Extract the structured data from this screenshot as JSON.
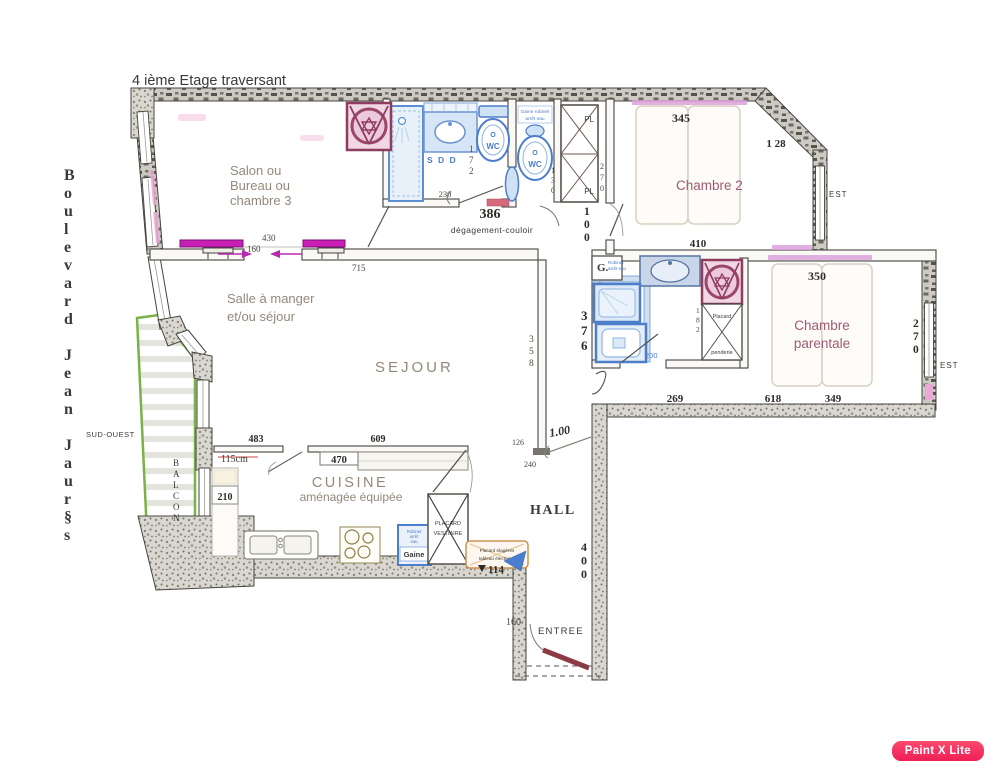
{
  "page": {
    "title": "4 ième Etage traversant",
    "watermark": "Paint X Lite"
  },
  "street": "Boulevard Jean Jaur§s",
  "orientation": {
    "sud_ouest": "SUD-OUEST",
    "est_chambre2": "EST",
    "est_parentale": "EST"
  },
  "rooms": {
    "salon": {
      "lines": [
        "Salon ou",
        "Bureau ou",
        "chambre 3"
      ]
    },
    "chambre2": "Chambre 2",
    "salle_a_manger": {
      "lines": [
        "Salle à manger",
        "et/ou séjour"
      ]
    },
    "sejour": "SEJOUR",
    "chambre_parentale": {
      "lines": [
        "Chambre",
        "parentale"
      ]
    },
    "cuisine": {
      "lines": [
        "CUISINE",
        "aménagée équipée"
      ]
    },
    "hall": "HALL",
    "entree": "ENTREE",
    "balcon": "BALCON",
    "couloir": "dégagement-couloir"
  },
  "fixtures": {
    "sdd": "S D D",
    "wc1": {
      "top": "O",
      "label": "WC"
    },
    "wc2": {
      "top": "O",
      "label": "WC"
    },
    "wc2_note": {
      "lines": [
        "Gaine robinet",
        "arrêt eau"
      ]
    },
    "pl_top": "PL",
    "pl_bottom": "PL",
    "g_box": {
      "label": "G.",
      "note": [
        "Robinet",
        "arrêt eau"
      ]
    },
    "gaine": {
      "label": "Gaine",
      "note": [
        "Robinet",
        "arrêt",
        "eau"
      ]
    },
    "placard_vestiaire": {
      "lines": [
        "PLACARD",
        "VESTIAIRE"
      ]
    },
    "placard_penderie": {
      "lines": [
        "Placard",
        "penderie"
      ]
    },
    "placard_etageres": {
      "lines": [
        "Placard étagères",
        "tableau électrique"
      ]
    }
  },
  "dimensions": {
    "salon_opening_width": "430",
    "salon_opening": "160",
    "sejour_wall_length": "715",
    "bath1_width": "230",
    "bath1_length": "386",
    "bath1_depth_v": "172",
    "wc2_width_v": "130",
    "placards_height_v": "270",
    "couloir_width_v": "100",
    "chambre2_width": "345",
    "chambre2_corner": "1 28",
    "chambre2_length": "410",
    "parentale_width": "350",
    "parentale_depth_v": "270",
    "parentale_seg1": "269",
    "parentale_seg2": "618",
    "parentale_seg3": "349",
    "bath2_depth_v": "376",
    "bath2_inner_v": "182",
    "bath2_width": "200",
    "sejour_depth_v": "358",
    "hall_seg1": "126",
    "hall_seg2": "240",
    "hall_opening": "1.00",
    "hall_depth_v": "400",
    "cuisine_seg1": "483",
    "cuisine_seg2": "609",
    "cuisine_counter": "470",
    "cuisine_window": "115cm",
    "cuisine_return": "210",
    "cuisine_seg3": "114",
    "entree_width": "160"
  },
  "colors": {
    "magenta_door": "#c81fb4",
    "hall_text": "#bd18a0",
    "blue_fixture": "#4d7ec9",
    "street_blue": "#2a4cc4",
    "maroon_ornament": "#9b4668",
    "balcony_green": "#79b347",
    "red_label": "#d4586a",
    "orange_label": "#c77f35",
    "watermark_bg": "#ef1e57"
  }
}
